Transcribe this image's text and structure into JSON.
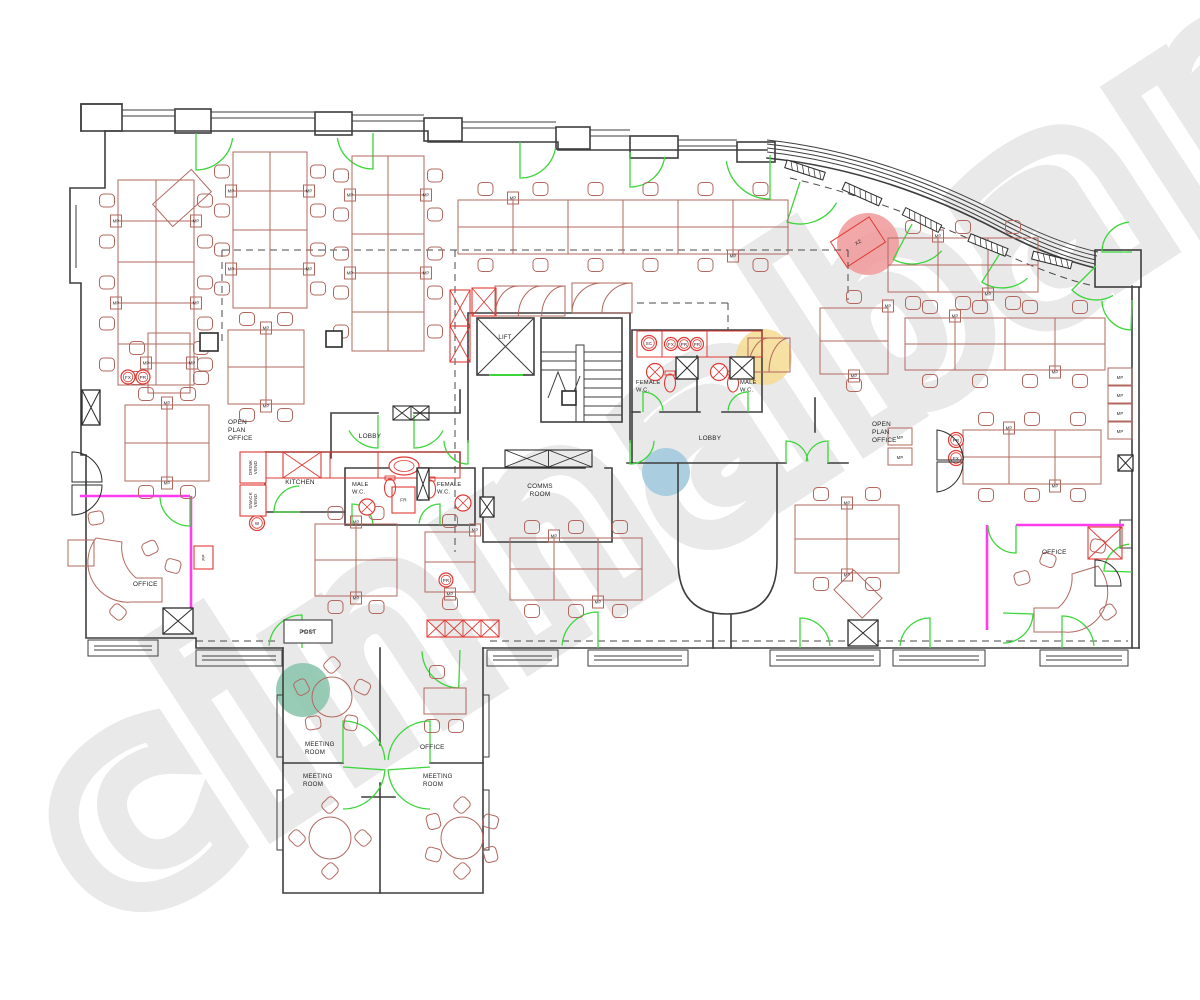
{
  "watermark": {
    "text": "cinnabar",
    "stroke_color": "#e9e9e9",
    "dots": [
      {
        "name": "red-dot",
        "color": "#f0999a",
        "x": 868,
        "y": 244,
        "r": 31,
        "opacity": 0.85
      },
      {
        "name": "yellow-dot",
        "color": "#f4db92",
        "x": 764,
        "y": 357,
        "r": 28,
        "opacity": 0.85
      },
      {
        "name": "blue-dot",
        "color": "#a6ccdf",
        "x": 666,
        "y": 472,
        "r": 24,
        "opacity": 0.95
      },
      {
        "name": "teal-dot",
        "color": "#8ec7af",
        "x": 303,
        "y": 690,
        "r": 27,
        "opacity": 0.9
      }
    ]
  },
  "colors": {
    "wall": "#3e3e3e",
    "furniture": "#b2685f",
    "fixture_red": "#e03a34",
    "door_green": "#3cd63c",
    "magenta": "#ff3bf0"
  },
  "labels": [
    {
      "id": "open-plan-office-left",
      "text": "OPEN\nPLAN\nOFFICE",
      "x": 228,
      "y": 424,
      "anchor": "start",
      "size": 6.4
    },
    {
      "id": "open-plan-office-right",
      "text": "OPEN\nPLAN\nOFFICE",
      "x": 872,
      "y": 426,
      "anchor": "start",
      "size": 6.4
    },
    {
      "id": "lobby-left",
      "text": "LOBBY",
      "x": 370,
      "y": 438,
      "anchor": "middle",
      "size": 6.4
    },
    {
      "id": "lobby-right",
      "text": "LOBBY",
      "x": 710,
      "y": 440,
      "anchor": "middle",
      "size": 6.4
    },
    {
      "id": "lift",
      "text": "LIFT",
      "x": 505,
      "y": 339,
      "anchor": "middle",
      "size": 6
    },
    {
      "id": "comms-room",
      "text": "COMMS\nROOM",
      "x": 540,
      "y": 488,
      "anchor": "middle",
      "size": 6.4
    },
    {
      "id": "kitchen",
      "text": "KITCHEN",
      "x": 300,
      "y": 484,
      "anchor": "middle",
      "size": 6.4
    },
    {
      "id": "female-wc-upper",
      "text": "FEMALE\nW.C.",
      "x": 636,
      "y": 384,
      "anchor": "start",
      "size": 5.8
    },
    {
      "id": "male-wc-upper",
      "text": "MALE\nW.C.",
      "x": 740,
      "y": 384,
      "anchor": "start",
      "size": 5.8
    },
    {
      "id": "male-wc-lower",
      "text": "MALE\nW.C.",
      "x": 352,
      "y": 486,
      "anchor": "start",
      "size": 5.8
    },
    {
      "id": "female-wc-lower",
      "text": "FEMALE\nW.C.",
      "x": 437,
      "y": 486,
      "anchor": "start",
      "size": 5.8
    },
    {
      "id": "office-bottom-left",
      "text": "OFFICE",
      "x": 133,
      "y": 586,
      "anchor": "start",
      "size": 6.4
    },
    {
      "id": "office-bottom-right",
      "text": "OFFICE",
      "x": 1042,
      "y": 554,
      "anchor": "start",
      "size": 6.4
    },
    {
      "id": "office-wing",
      "text": "OFFICE",
      "x": 420,
      "y": 749,
      "anchor": "start",
      "size": 6.4
    },
    {
      "id": "meeting-room-1",
      "text": "MEETING\nROOM",
      "x": 305,
      "y": 746,
      "anchor": "start",
      "size": 6.2
    },
    {
      "id": "meeting-room-2",
      "text": "MEETING\nROOM",
      "x": 303,
      "y": 778,
      "anchor": "start",
      "size": 6.2
    },
    {
      "id": "meeting-room-3",
      "text": "MEETING\nROOM",
      "x": 423,
      "y": 778,
      "anchor": "start",
      "size": 6.2
    },
    {
      "id": "post",
      "text": "POST",
      "x": 308,
      "y": 634,
      "anchor": "middle",
      "size": 6
    }
  ],
  "furniture": {
    "desk_tag": "MP",
    "benches": [
      {
        "x": 118,
        "y": 180,
        "cols": 2,
        "rows": 5,
        "cw": 38,
        "ch": 41,
        "side": "lr"
      },
      {
        "x": 233,
        "y": 152,
        "cols": 2,
        "rows": 4,
        "cw": 37,
        "ch": 39,
        "side": "lr"
      },
      {
        "x": 352,
        "y": 156,
        "cols": 2,
        "rows": 5,
        "cw": 36,
        "ch": 39,
        "side": "lr"
      },
      {
        "x": 458,
        "y": 200,
        "cols": 6,
        "rows": 2,
        "cw": 55,
        "ch": 27,
        "side": "tb"
      },
      {
        "x": 888,
        "y": 238,
        "cols": 3,
        "rows": 2,
        "cw": 50,
        "ch": 27,
        "side": "tb"
      },
      {
        "x": 905,
        "y": 318,
        "cols": 4,
        "rows": 2,
        "cw": 50,
        "ch": 26,
        "side": "tb"
      },
      {
        "x": 963,
        "y": 430,
        "cols": 3,
        "rows": 2,
        "cw": 46,
        "ch": 27,
        "side": "tb"
      },
      {
        "x": 820,
        "y": 308,
        "cols": 1,
        "rows": 2,
        "cw": 68,
        "ch": 33,
        "side": "tb"
      },
      {
        "x": 315,
        "y": 524,
        "cols": 2,
        "rows": 2,
        "cw": 41,
        "ch": 36,
        "side": "tb"
      },
      {
        "x": 510,
        "y": 538,
        "cols": 3,
        "rows": 2,
        "cw": 44,
        "ch": 31,
        "side": "tb"
      },
      {
        "x": 425,
        "y": 532,
        "cols": 1,
        "rows": 2,
        "cw": 50,
        "ch": 30,
        "side": "tb"
      },
      {
        "x": 795,
        "y": 505,
        "cols": 2,
        "rows": 2,
        "cw": 52,
        "ch": 34,
        "side": "tb"
      },
      {
        "x": 228,
        "y": 330,
        "cols": 2,
        "rows": 2,
        "cw": 38,
        "ch": 37,
        "side": "tb"
      },
      {
        "x": 125,
        "y": 405,
        "cols": 2,
        "rows": 2,
        "cw": 42,
        "ch": 38,
        "side": "tb"
      },
      {
        "x": 148,
        "y": 333,
        "cols": 1,
        "rows": 2,
        "cw": 42,
        "ch": 30,
        "side": "lr"
      }
    ],
    "round_tables": [
      {
        "x": 332,
        "y": 697,
        "r": 20,
        "chairs": 5
      },
      {
        "x": 330,
        "y": 838,
        "r": 21,
        "chairs": 4
      },
      {
        "x": 462,
        "y": 838,
        "r": 21,
        "chairs": 6
      }
    ],
    "rotated_desks": [
      {
        "x": 182,
        "y": 198,
        "w": 52,
        "h": 30,
        "rot": -42
      },
      {
        "x": 858,
        "y": 242,
        "w": 46,
        "h": 30,
        "rot": -33,
        "tag": "X2",
        "red": true
      },
      {
        "x": 858,
        "y": 594,
        "w": 40,
        "h": 28,
        "rot": 45
      }
    ],
    "wall_units": [
      {
        "x": 1108,
        "y": 368
      },
      {
        "x": 1108,
        "y": 386
      },
      {
        "x": 1108,
        "y": 404
      },
      {
        "x": 1108,
        "y": 422
      },
      {
        "x": 888,
        "y": 428
      },
      {
        "x": 888,
        "y": 448
      }
    ],
    "cupboards": [
      {
        "x": 495,
        "y": 286,
        "w": 70,
        "h": 30,
        "fans": 3
      },
      {
        "x": 572,
        "y": 283,
        "w": 60,
        "h": 30,
        "fans": 2
      },
      {
        "x": 748,
        "y": 338,
        "w": 42,
        "h": 34,
        "fans": 2
      }
    ]
  },
  "fixtures": {
    "service_circles": [
      {
        "code": "SC",
        "x": 649,
        "y": 343,
        "r": 7.5
      },
      {
        "code": "FX",
        "x": 671,
        "y": 344,
        "r": 6.5
      },
      {
        "code": "PR",
        "x": 684,
        "y": 344,
        "r": 6.5
      },
      {
        "code": "PR",
        "x": 697,
        "y": 344,
        "r": 6.5
      },
      {
        "code": "FX",
        "x": 128,
        "y": 377,
        "r": 7
      },
      {
        "code": "PR",
        "x": 143,
        "y": 377,
        "r": 7
      },
      {
        "code": "PR",
        "x": 446,
        "y": 580,
        "r": 7
      },
      {
        "code": "PR",
        "x": 956,
        "y": 440,
        "r": 7.5
      },
      {
        "code": "FX",
        "x": 956,
        "y": 458,
        "r": 7.5
      },
      {
        "code": "W",
        "x": 257,
        "y": 523,
        "r": 7.5
      }
    ],
    "labeled_boxes": [
      {
        "label": "DRINK\nVEND",
        "x": 240,
        "y": 452,
        "w": 26,
        "h": 31,
        "rot": -90,
        "red": true
      },
      {
        "label": "SNACK\nVEND",
        "x": 240,
        "y": 485,
        "w": 26,
        "h": 31,
        "rot": -90,
        "red": true
      },
      {
        "label": "FR",
        "x": 392,
        "y": 487,
        "w": 23,
        "h": 26,
        "rot": 0,
        "red": true
      },
      {
        "label": "FP",
        "x": 194,
        "y": 546,
        "w": 19,
        "h": 23,
        "rot": -90,
        "red": true
      },
      {
        "label": "POST",
        "x": 284,
        "y": 620,
        "w": 48,
        "h": 23,
        "rot": 0,
        "red": false
      }
    ],
    "toilets": [
      {
        "x": 670,
        "y": 383
      },
      {
        "x": 733,
        "y": 383
      },
      {
        "x": 390,
        "y": 488
      },
      {
        "x": 430,
        "y": 489
      }
    ],
    "basins": [
      {
        "x": 655,
        "y": 372,
        "r": 8.5
      },
      {
        "x": 719,
        "y": 372,
        "r": 8.5
      },
      {
        "x": 367,
        "y": 507,
        "r": 8
      },
      {
        "x": 463,
        "y": 503,
        "r": 8
      }
    ],
    "sinks": [
      {
        "x": 404,
        "y": 466
      }
    ]
  },
  "doors": [
    [
      196,
      133,
      37,
      90,
      8,
      0
    ],
    [
      373,
      133,
      36,
      90,
      172,
      1
    ],
    [
      520,
      142,
      36,
      90,
      10,
      0
    ],
    [
      630,
      152,
      35,
      90,
      8,
      0
    ],
    [
      770,
      155,
      44,
      90,
      172,
      1
    ],
    [
      800,
      182,
      42,
      108,
      30,
      0
    ],
    [
      912,
      224,
      40,
      118,
      42,
      0
    ],
    [
      1002,
      250,
      38,
      122,
      48,
      0
    ],
    [
      1096,
      266,
      34,
      135,
      60,
      0
    ],
    [
      1132,
      252,
      30,
      180,
      264,
      1
    ],
    [
      1132,
      300,
      30,
      92,
      178,
      1
    ],
    [
      468,
      440,
      24,
      90,
      178,
      1
    ],
    [
      630,
      440,
      24,
      90,
      2,
      0
    ],
    [
      643,
      412,
      20,
      270,
      356,
      1
    ],
    [
      748,
      412,
      20,
      270,
      184,
      0
    ],
    [
      352,
      525,
      21,
      270,
      356,
      1
    ],
    [
      440,
      525,
      21,
      270,
      184,
      0
    ],
    [
      378,
      415,
      33,
      90,
      152,
      1
    ],
    [
      414,
      415,
      33,
      90,
      28,
      0
    ],
    [
      786,
      463,
      22,
      270,
      356,
      1
    ],
    [
      828,
      463,
      22,
      270,
      184,
      0
    ],
    [
      300,
      512,
      26,
      180,
      268,
      1
    ],
    [
      190,
      496,
      30,
      90,
      178,
      1
    ],
    [
      1016,
      525,
      28,
      90,
      178,
      1
    ],
    [
      1132,
      572,
      28,
      182,
      264,
      1
    ],
    [
      1003,
      613,
      30,
      2,
      90,
      1
    ],
    [
      302,
      648,
      33,
      270,
      184,
      0
    ],
    [
      598,
      648,
      36,
      270,
      184,
      0
    ],
    [
      800,
      648,
      30,
      270,
      356,
      1
    ],
    [
      930,
      648,
      30,
      270,
      184,
      0
    ],
    [
      1062,
      648,
      32,
      270,
      356,
      1
    ],
    [
      343,
      763,
      42,
      270,
      356,
      1
    ],
    [
      430,
      763,
      42,
      270,
      184,
      0
    ],
    [
      343,
      767,
      42,
      4,
      90,
      1
    ],
    [
      430,
      767,
      42,
      176,
      90,
      0
    ],
    [
      460,
      650,
      38,
      92,
      178,
      1
    ]
  ],
  "structure": {
    "columns": [
      {
        "x": 200,
        "y": 333,
        "s": 18
      },
      {
        "x": 326,
        "y": 331,
        "s": 16
      },
      {
        "x": 562,
        "y": 391,
        "s": 14
      }
    ],
    "ducts": [
      {
        "x": 82,
        "y": 390,
        "w": 18,
        "h": 35
      },
      {
        "x": 676,
        "y": 357,
        "w": 22,
        "h": 22
      },
      {
        "x": 730,
        "y": 357,
        "w": 24,
        "h": 22
      },
      {
        "x": 417,
        "y": 468,
        "w": 12,
        "h": 32
      },
      {
        "x": 1118,
        "y": 455,
        "w": 15,
        "h": 16
      },
      {
        "x": 848,
        "y": 620,
        "w": 30,
        "h": 26
      },
      {
        "x": 480,
        "y": 497,
        "w": 14,
        "h": 20
      },
      {
        "x": 163,
        "y": 608,
        "w": 30,
        "h": 26
      }
    ],
    "hatch_strips": [
      {
        "x": 505,
        "y": 450,
        "w": 87,
        "h": 17,
        "cells": 2,
        "red": false
      },
      {
        "x": 393,
        "y": 406,
        "w": 36,
        "h": 14,
        "cells": 2,
        "red": false
      },
      {
        "x": 427,
        "y": 620,
        "w": 72,
        "h": 17,
        "cells": 4,
        "red": true
      },
      {
        "x": 283,
        "y": 452,
        "w": 38,
        "h": 26,
        "cells": 1,
        "red": true
      },
      {
        "x": 1088,
        "y": 527,
        "w": 34,
        "h": 32,
        "cells": 1,
        "red": true
      },
      {
        "x": 450,
        "y": 290,
        "w": 20,
        "h": 36,
        "cells": 1,
        "red": true
      },
      {
        "x": 450,
        "y": 326,
        "w": 20,
        "h": 36,
        "cells": 1,
        "red": true
      },
      {
        "x": 472,
        "y": 288,
        "w": 24,
        "h": 28,
        "cells": 1,
        "red": true
      }
    ],
    "sills": [
      {
        "x": 805,
        "y": 170,
        "rot": 18
      },
      {
        "x": 862,
        "y": 194,
        "rot": 24
      },
      {
        "x": 922,
        "y": 220,
        "rot": 26
      },
      {
        "x": 988,
        "y": 245,
        "rot": 22
      },
      {
        "x": 1052,
        "y": 260,
        "rot": 14
      }
    ]
  }
}
